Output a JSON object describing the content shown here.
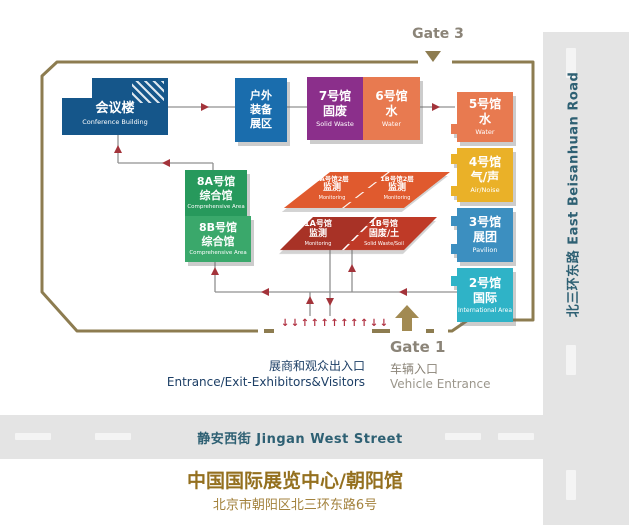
{
  "roads": {
    "east": "北三环东路 East Beisanhuan Road",
    "south": "静安西街 Jingan West Street"
  },
  "gates": {
    "gate3": "Gate 3",
    "gate1": "Gate 1",
    "vehicle_zh": "车辆入口",
    "vehicle_en": "Vehicle Entrance"
  },
  "entrance": {
    "zh": "展商和观众出入口",
    "en": "Entrance/Exit-Exhibitors&Visitors",
    "pedestrian_arrows": "↓↓↑↑↑↑↑↑↑↓↓"
  },
  "halls": {
    "conference": {
      "name": "会议楼",
      "en": "Conference Building",
      "color": "#15568a"
    },
    "outdoor": {
      "l1": "户外",
      "l2": "装备",
      "l3": "展区",
      "color": "#1a6dad"
    },
    "hall7": {
      "name": "7号馆",
      "sub": "固废",
      "en": "Solid Waste",
      "color": "#8b2f8b"
    },
    "hall6": {
      "name": "6号馆",
      "sub": "水",
      "en": "Water",
      "color": "#e87a50"
    },
    "hall5": {
      "name": "5号馆",
      "sub": "水",
      "en": "Water",
      "color": "#e87a50"
    },
    "hall4": {
      "name": "4号馆",
      "sub": "气/声",
      "en": "Air/Noise",
      "color": "#eab128"
    },
    "hall3": {
      "name": "3号馆",
      "sub": "展团",
      "en": "Pavilion",
      "color": "#3c8fc0"
    },
    "hall2": {
      "name": "2号馆",
      "sub": "国际",
      "en": "International Area",
      "color": "#2fb3c7"
    },
    "hall8a": {
      "name": "8A号馆",
      "sub": "综合馆",
      "en": "Comprehensive Area",
      "color": "#27995c"
    },
    "hall8b": {
      "name": "8B号馆",
      "sub": "综合馆",
      "en": "Comprehensive Area",
      "color": "#3aa86b"
    },
    "hall1a2": {
      "name": "1A号馆2层",
      "sub": "监测",
      "en": "Monitoring",
      "color": "#e05a2e"
    },
    "hall1b2": {
      "name": "1B号馆2层",
      "sub": "监测",
      "en": "Monitoring",
      "color": "#e05a2e"
    },
    "hall1a": {
      "name": "1A号馆",
      "sub": "监测",
      "en": "Monitoring",
      "color": "#a83226"
    },
    "hall1b": {
      "name": "1B号馆",
      "sub": "固废/土",
      "en": "Solid Waste/Soil",
      "color": "#bf3a27"
    }
  },
  "footer": {
    "title": "中国国际展览中心/朝阳馆",
    "address": "北京市朝阳区北三环东路6号"
  },
  "theme": {
    "border": "#8d7c50",
    "arrow_red": "#a3333a",
    "road_gray": "#e4e4e4"
  }
}
